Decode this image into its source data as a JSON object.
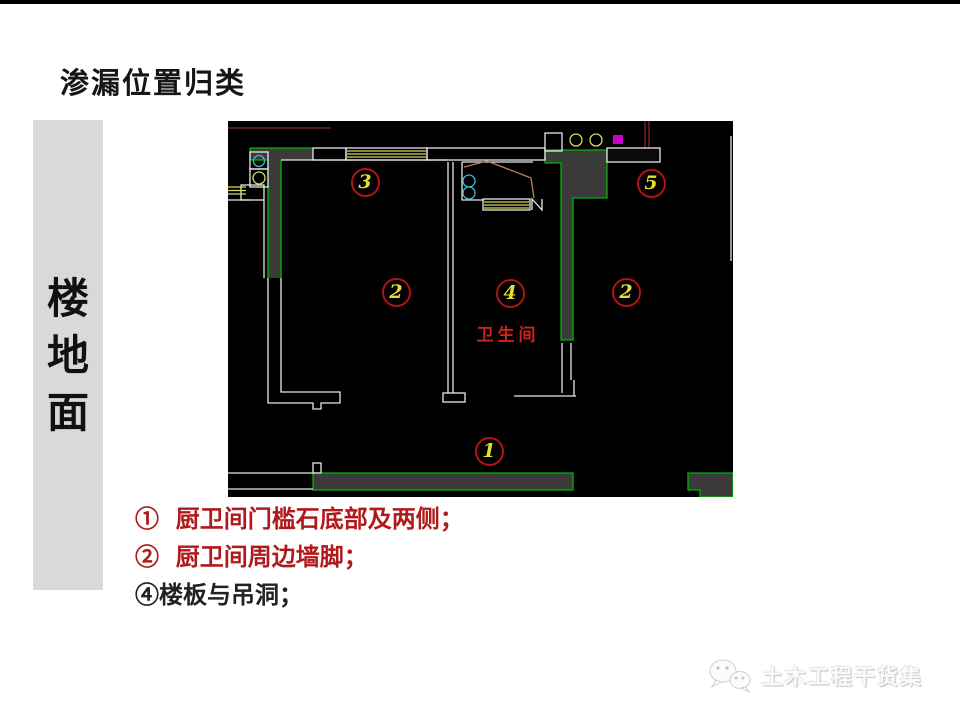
{
  "page": {
    "title": "渗漏位置归类",
    "sidebar": {
      "label": "楼地面",
      "chars": [
        "楼",
        "地",
        "面"
      ],
      "bg": "#d9d9d9"
    },
    "annotations": [
      {
        "text": "①  厨卫间门槛石底部及两侧；",
        "color": "#b2191c"
      },
      {
        "text": "②  厨卫间周边墙脚；",
        "color": "#b2191c"
      },
      {
        "text": "④楼板与吊洞；",
        "color": "#222222"
      }
    ],
    "watermark": {
      "text": "土木工程干货集",
      "icon": "wechat-icon"
    }
  },
  "floor_plan": {
    "room_label": {
      "text": "卫生间",
      "x": 280,
      "y": 212,
      "color": "#c8231c"
    },
    "markers": [
      {
        "num": "3",
        "x": 137,
        "y": 61
      },
      {
        "num": "5",
        "x": 423,
        "y": 62
      },
      {
        "num": "2",
        "x": 168,
        "y": 171
      },
      {
        "num": "4",
        "x": 282,
        "y": 172
      },
      {
        "num": "2",
        "x": 398,
        "y": 171
      },
      {
        "num": "1",
        "x": 261,
        "y": 330
      }
    ],
    "marker_circle_color": "#b11414",
    "marker_number_color": "#e6df2e",
    "colors": {
      "wall_green": "#00b400",
      "wall_fill": "#3b3b3b",
      "line_white": "#e8e8e8",
      "hatch_yellow": "#d8d860",
      "fixture_cyan": "#3fb9cf",
      "accent_magenta": "#cc00cc",
      "door_salmon": "#c47a55",
      "line_darkred": "#7c2828",
      "background": "#000000"
    }
  }
}
